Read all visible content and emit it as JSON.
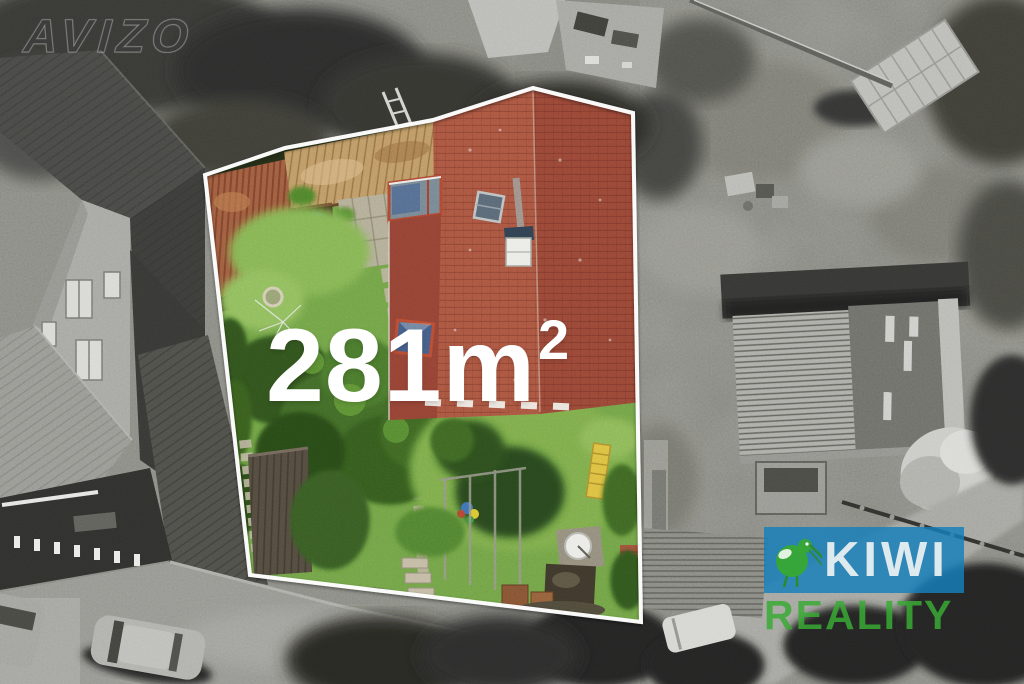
{
  "overlay": {
    "watermark": "AVIZO",
    "area": {
      "value": "281",
      "unit": "m",
      "exponent": "2"
    }
  },
  "brand": {
    "name": "KIWI",
    "subtitle": "REALITY",
    "icon": "kiwi-bird-icon",
    "colors": {
      "box_blue": "#1580bb",
      "kiwi_green": "#38a834",
      "subtitle_green": "#3aaa35",
      "name_text": "#eef2f2"
    }
  },
  "boundary": {
    "color": "#ffffff",
    "points": "205,175 285,148 433,120 533,88 633,113 641,622 250,575"
  },
  "palette": {
    "main_roof_red": "#9c4b3c",
    "lawn_green": "#6a9a43",
    "wood_deck_tan": "#b8915f",
    "rust_roof_brown": "#96573c",
    "exterior_gray": "#82827d"
  }
}
